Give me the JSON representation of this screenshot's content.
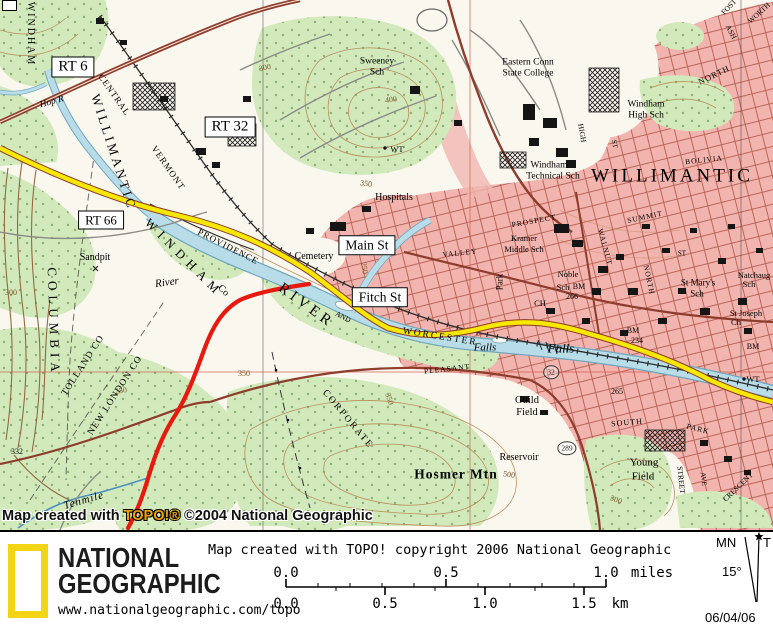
{
  "map": {
    "boxes": {
      "rt6": "RT 6",
      "rt32": "RT 32",
      "rt66": "RT 66",
      "main": "Main St",
      "fitch": "Fitch St"
    },
    "labels": {
      "windham_vert": "WINDHAM",
      "hop_r": "Hop R",
      "central": "CENTRAL",
      "vermont": "VERMONT",
      "willimantic_river": "WILLIMANTIC",
      "river_big": "RIVER",
      "and": "AND",
      "worcester": "WORCESTER",
      "providence": "PROVIDENCE",
      "falls_w": "Falls",
      "falls_e": "Falls",
      "columbia": "COLUMBIA",
      "windham_co": "WINDHAM",
      "windham_co_suffix": "Co",
      "tolland_co": "TOLLAND CO",
      "new_london_co": "NEW LONDON CO",
      "sandpit": "Sandpit",
      "river_small": "River",
      "sweeney_1": "Sweeney",
      "sweeney_2": "Sch",
      "wt_hill": "WT",
      "eastern_1": "Eastern Conn",
      "eastern_2": "State College",
      "whs_1": "Windham",
      "whs_2": "High Sch",
      "wts_1": "Windham",
      "wts_2": "Technical Sch",
      "willimantic_city": "WILLIMANTIC",
      "hospitals": "Hospitals",
      "cemetery": "Cemetery",
      "kramer_1": "Kramer",
      "kramer_2": "Middle Sch",
      "noble_1": "Noble",
      "noble_2": "Sch",
      "bm266_1": "BM",
      "bm266_2": "266",
      "ch": "CH",
      "stmarys_1": "St Mary's",
      "stmarys_2": "Sch",
      "natchaug_1": "Natchaug",
      "natchaug_2": "Sch",
      "stjoseph_1": "St Joseph",
      "stjoseph_2": "Ch",
      "prospect": "PROSPECT",
      "valley": "VALLEY",
      "park_n": "Park",
      "summit": "SUMMIT",
      "walnut": "WALNUT",
      "north_st": "NORTH",
      "north_tr": "NORTH",
      "ash": "ASH",
      "fost": "FOST",
      "worth": "WORTH",
      "high": "HIGH",
      "st_a": "ST",
      "st_b": "ST",
      "bolivia": "BOLIVIA",
      "pleasant": "PLEASANT",
      "south": "SOUTH",
      "park_s": "PARK",
      "street_v": "STREET",
      "ave_v": "AVE",
      "crescent": "CRESCENT",
      "guild_1": "Guild",
      "guild_2": "Field",
      "young_1": "Young",
      "young_2": "Field",
      "hosmer": "Hosmer Mtn",
      "reservoir": "Reservoir",
      "tenmile": "Tenmile",
      "wt_e": "WT",
      "bm234_1": "BM",
      "bm234_2": "234",
      "bm_e": "BM",
      "elev265": "265",
      "elev332": "332",
      "c300_nw": "300",
      "c400": "400",
      "c350_n": "350",
      "c250_v": "250",
      "c500": "500",
      "c350_s": "350",
      "c300_se": "300",
      "c250_w": "250",
      "c350_w": "350",
      "c300_w": "300",
      "corporate": "CORPORATE",
      "shield289": "289",
      "shield32": "32"
    },
    "watermark": {
      "prefix": "Map created with ",
      "brand": "TOPO!®",
      "suffix": " ©2004 National Geographic"
    }
  },
  "footer": {
    "brand": {
      "line1": "NATIONAL",
      "line2": "GEOGRAPHIC",
      "url": "www.nationalgeographic.com/topo"
    },
    "copyright": "Map created with TOPO! copyright 2006 National Geographic",
    "scale": {
      "mi_0": "0.0",
      "mi_05": "0.5",
      "mi_1": "1.0",
      "mi_unit": "miles",
      "km_0": "0.0",
      "km_05": "0.5",
      "km_1": "1.0",
      "km_15": "1.5",
      "km_unit": "km"
    },
    "declination": {
      "mn": "MN",
      "true_label": "T",
      "angle": "15°",
      "date": "06/04/06"
    }
  },
  "colors": {
    "urban_pink": "#f2b4ae",
    "woodland_green": "#d2e9bc",
    "water_blue": "#b9dde8",
    "route_highlight_yellow": "#f6e800",
    "gps_track_red": "#e8190f",
    "road_maroon": "#8e3c2c",
    "logo_yellow": "#f3d515",
    "topo_brand_orange": "#f0a200"
  }
}
